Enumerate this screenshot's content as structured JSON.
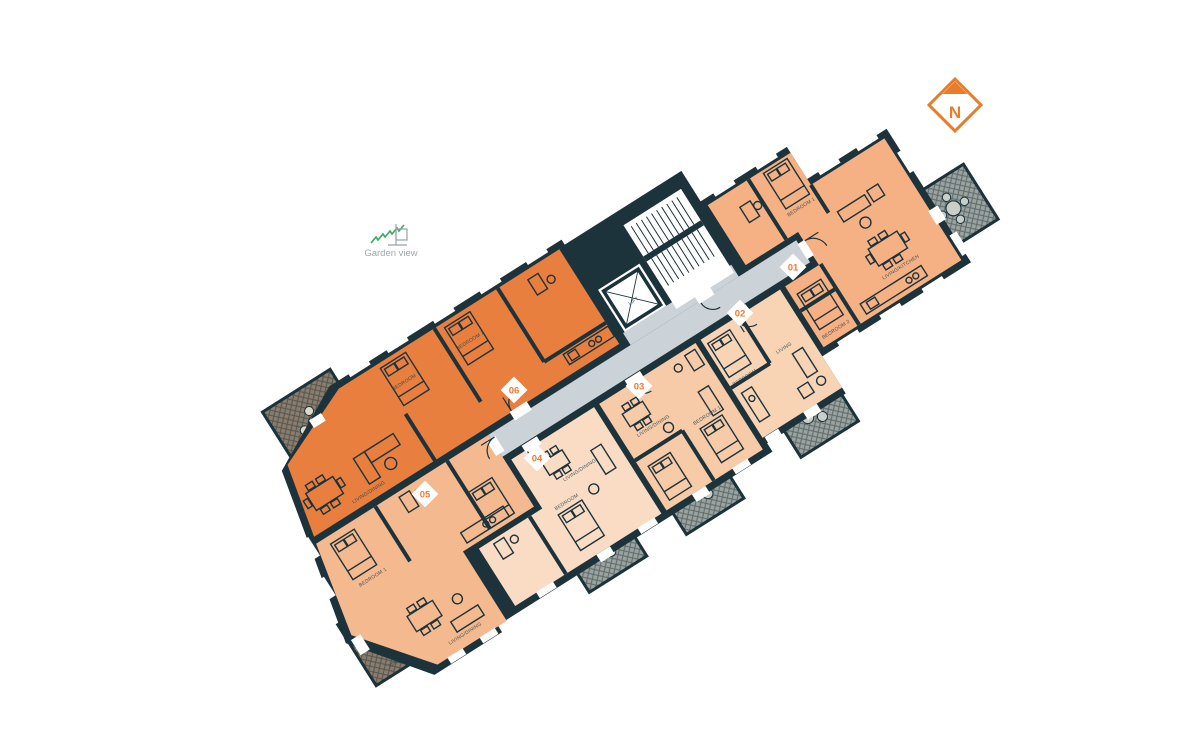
{
  "north_indicator": {
    "label": "N",
    "color": "#e87c28"
  },
  "garden_view": {
    "label": "Garden view",
    "zigzag_color": "#3fa968",
    "text_color": "#a2a7a9"
  },
  "floorplan": {
    "rotation_deg": -32.3,
    "origin": {
      "x": 450,
      "y": 400
    },
    "colors": {
      "walls": "#1d333c",
      "corridor": "#ccd3d8",
      "core_floor": "#ffffff",
      "terrace_brown": "#8a7d6e",
      "terrace_gray": "#9ba3a0",
      "marker_text": "#ed7b31",
      "unit_01": "#f5b183",
      "unit_02": "#f8d3b4",
      "unit_03": "#f7cba8",
      "unit_04": "#f9dcc3",
      "unit_05": "#f4b98e",
      "unit_06": "#e87f3e"
    },
    "core": {
      "lift_label": "LIFT",
      "stairs_label": "STAIRS"
    },
    "terrace_label": "TERRACE",
    "units": [
      {
        "id": "01",
        "marker_x": 793,
        "marker_y": 267,
        "rooms": [
          "BEDROOM 1",
          "BEDROOM 2",
          "LIVING/KITCHEN"
        ]
      },
      {
        "id": "02",
        "marker_x": 740,
        "marker_y": 313,
        "rooms": [
          "BEDROOM",
          "LIVING"
        ]
      },
      {
        "id": "03",
        "marker_x": 639,
        "marker_y": 386,
        "rooms": [
          "LIVING/DINING",
          "BEDROOM 1"
        ]
      },
      {
        "id": "04",
        "marker_x": 537,
        "marker_y": 458,
        "rooms": [
          "LIVING/DINING",
          "BEDROOM"
        ]
      },
      {
        "id": "05",
        "marker_x": 425,
        "marker_y": 494,
        "rooms": [
          "BEDROOM 1",
          "LIVING/DINING"
        ]
      },
      {
        "id": "06",
        "marker_x": 514,
        "marker_y": 390,
        "rooms": [
          "BEDROOM 1",
          "BEDROOM 2",
          "LIVING/DINING"
        ]
      }
    ]
  }
}
